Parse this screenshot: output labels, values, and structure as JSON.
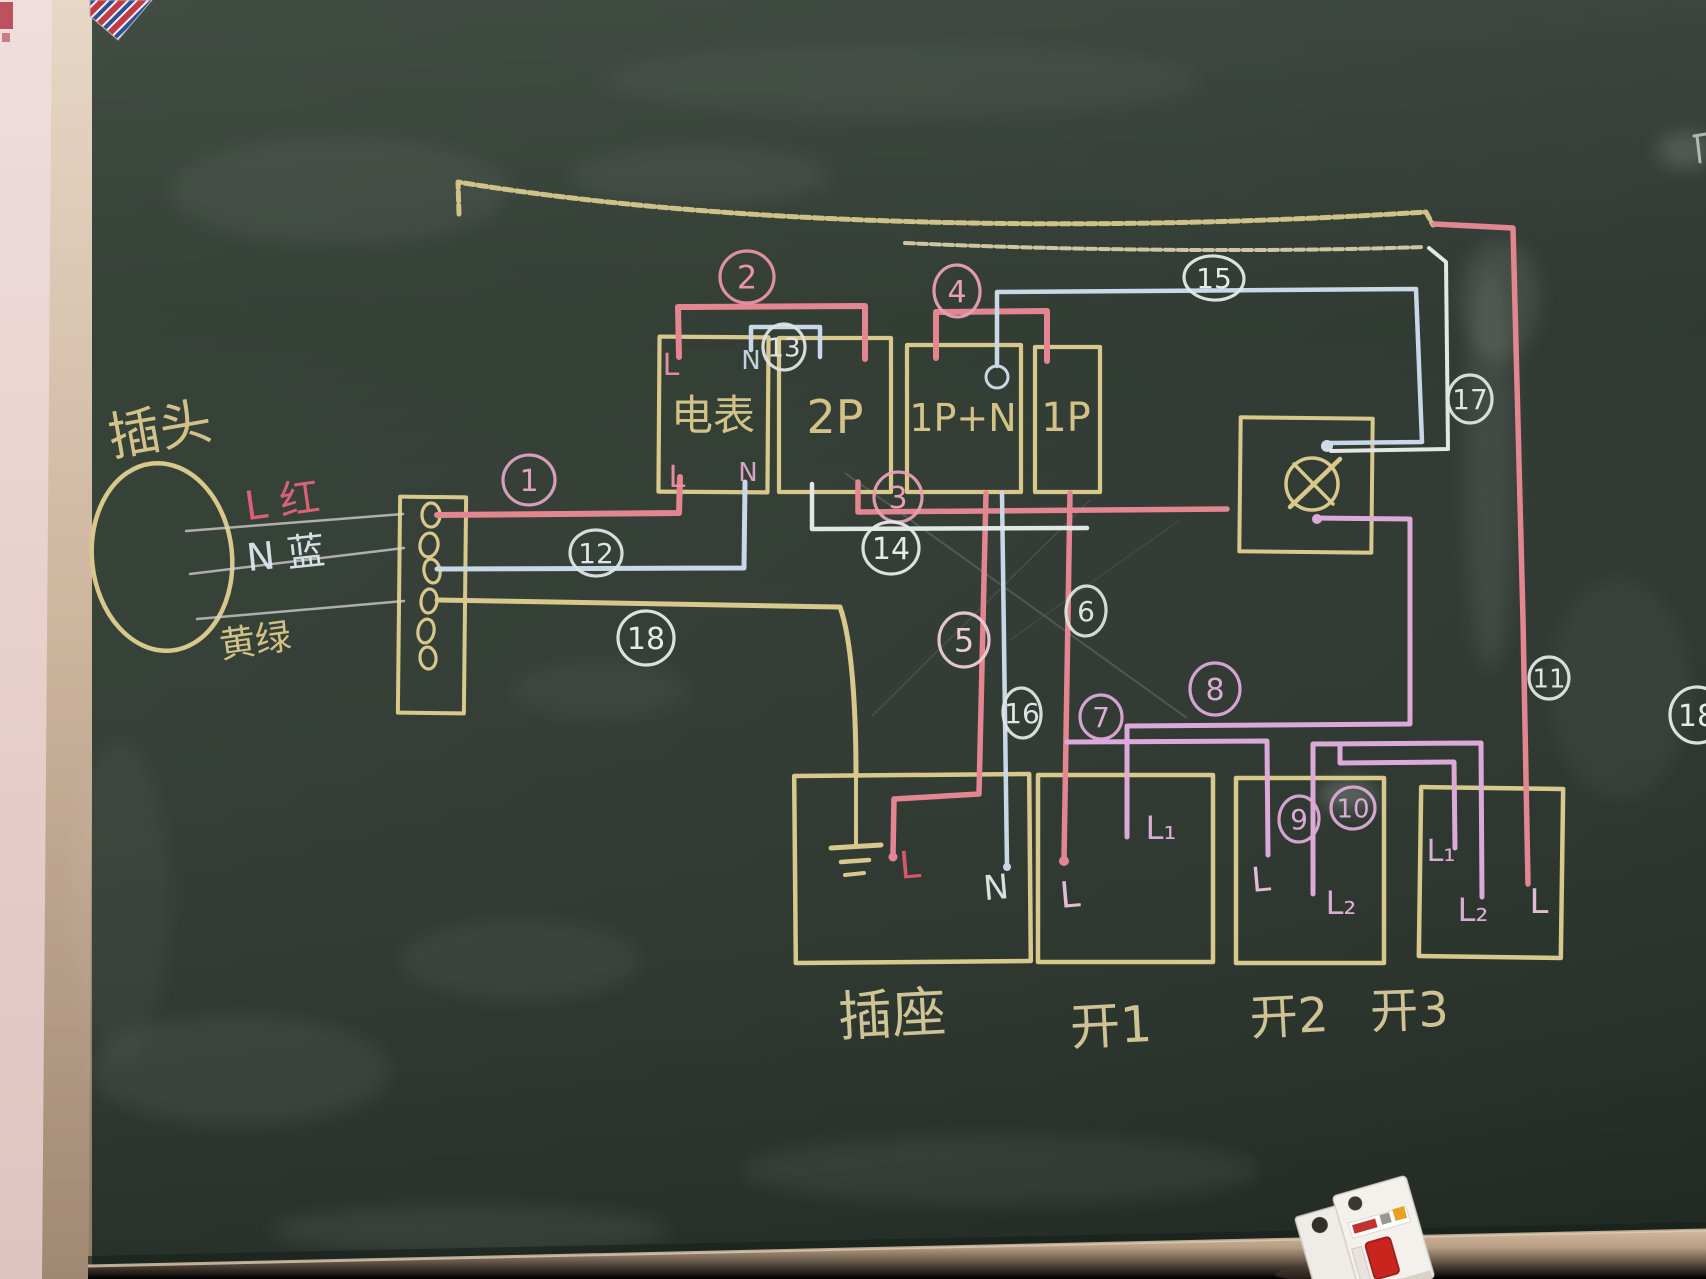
{
  "diagram": {
    "labels": [
      {
        "id": "plug-title",
        "text": "插头",
        "x": 163,
        "y": 447,
        "size": 52,
        "color": "#dcca8e",
        "rot": -10
      },
      {
        "id": "wire-live-label",
        "text": "L 红",
        "x": 284,
        "y": 515,
        "size": 40,
        "color": "#e3647c",
        "rot": -8
      },
      {
        "id": "wire-neutral-label",
        "text": "N 蓝",
        "x": 287,
        "y": 567,
        "size": 38,
        "color": "#dde7ee",
        "rot": -6
      },
      {
        "id": "wire-ground-label",
        "text": "黄绿",
        "x": 257,
        "y": 653,
        "size": 36,
        "color": "#d9c98c",
        "rot": -8
      },
      {
        "id": "meter-name",
        "text": "电表",
        "x": 713,
        "y": 430,
        "size": 42,
        "color": "#dcca8e",
        "rot": 0
      },
      {
        "id": "breaker-2p-name",
        "text": "2P",
        "x": 835,
        "y": 433,
        "size": 46,
        "color": "#dcca8e",
        "rot": 0
      },
      {
        "id": "breaker-1pn-name",
        "text": "1P+N",
        "x": 963,
        "y": 431,
        "size": 38,
        "color": "#dcca8e",
        "rot": 0
      },
      {
        "id": "breaker-1p-name",
        "text": "1P",
        "x": 1066,
        "y": 431,
        "size": 40,
        "color": "#dcca8e",
        "rot": 0
      },
      {
        "id": "socket-name",
        "text": "插座",
        "x": 893,
        "y": 1033,
        "size": 54,
        "color": "#d8cc9c",
        "rot": -3
      },
      {
        "id": "switch1-name",
        "text": "开1",
        "x": 1112,
        "y": 1043,
        "size": 50,
        "color": "#d8cc9c",
        "rot": -3
      },
      {
        "id": "switch2-name",
        "text": "开2",
        "x": 1290,
        "y": 1033,
        "size": 48,
        "color": "#d8cc9c",
        "rot": -3
      },
      {
        "id": "switch3-name",
        "text": "开3",
        "x": 1410,
        "y": 1027,
        "size": 48,
        "color": "#d8cc9c",
        "rot": -2
      },
      {
        "id": "meter-l-top",
        "text": "L",
        "x": 671,
        "y": 375,
        "size": 30,
        "color": "#ea93a6",
        "rot": 0
      },
      {
        "id": "meter-n-top",
        "text": "N",
        "x": 751,
        "y": 369,
        "size": 26,
        "color": "#ccdae8",
        "rot": 0
      },
      {
        "id": "meter-l-bottom",
        "text": "L",
        "x": 677,
        "y": 487,
        "size": 30,
        "color": "#ea93a6",
        "rot": 0
      },
      {
        "id": "meter-n-bottom",
        "text": "N",
        "x": 748,
        "y": 481,
        "size": 26,
        "color": "#dcaace",
        "rot": 0
      },
      {
        "id": "socket-l",
        "text": "L",
        "x": 911,
        "y": 878,
        "size": 38,
        "color": "#e0586f",
        "rot": -5
      },
      {
        "id": "socket-n",
        "text": "N",
        "x": 997,
        "y": 899,
        "size": 34,
        "color": "#e4e9ea",
        "rot": -5
      },
      {
        "id": "switch1-l",
        "text": "L",
        "x": 1071,
        "y": 907,
        "size": 36,
        "color": "#eec2de",
        "rot": -5
      },
      {
        "id": "switch1-l1",
        "text": "L₁",
        "x": 1161,
        "y": 839,
        "size": 32,
        "color": "#e2b6dc",
        "rot": 0
      },
      {
        "id": "switch2-l",
        "text": "L",
        "x": 1262,
        "y": 891,
        "size": 34,
        "color": "#eec2de",
        "rot": -5
      },
      {
        "id": "switch2-l2",
        "text": "L₂",
        "x": 1341,
        "y": 914,
        "size": 32,
        "color": "#e2b6dc",
        "rot": 0
      },
      {
        "id": "switch3-l1",
        "text": "L₁",
        "x": 1441,
        "y": 861,
        "size": 30,
        "color": "#e2b6dc",
        "rot": 0
      },
      {
        "id": "switch3-l2",
        "text": "L₂",
        "x": 1473,
        "y": 921,
        "size": 32,
        "color": "#e2b6dc",
        "rot": 0
      },
      {
        "id": "switch3-l",
        "text": "L",
        "x": 1539,
        "y": 913,
        "size": 34,
        "color": "#eec2de",
        "rot": 0
      }
    ],
    "badges": [
      {
        "n": "1",
        "x": 529,
        "y": 480,
        "rx": 26,
        "ry": 25,
        "color": "#e0a2c2",
        "fs": 30
      },
      {
        "n": "2",
        "x": 747,
        "y": 277,
        "rx": 27,
        "ry": 26,
        "color": "#ea94a4",
        "fs": 32
      },
      {
        "n": "3",
        "x": 898,
        "y": 497,
        "rx": 24,
        "ry": 25,
        "color": "#e8a0b4",
        "fs": 30
      },
      {
        "n": "4",
        "x": 957,
        "y": 291,
        "rx": 23,
        "ry": 26,
        "color": "#e8a0b4",
        "fs": 30
      },
      {
        "n": "5",
        "x": 964,
        "y": 640,
        "rx": 25,
        "ry": 27,
        "color": "#eccad8",
        "fs": 32
      },
      {
        "n": "6",
        "x": 1086,
        "y": 611,
        "rx": 20,
        "ry": 25,
        "color": "#dde2e0",
        "fs": 28
      },
      {
        "n": "7",
        "x": 1101,
        "y": 717,
        "rx": 21,
        "ry": 22,
        "color": "#dcaad8",
        "fs": 28
      },
      {
        "n": "8",
        "x": 1215,
        "y": 689,
        "rx": 25,
        "ry": 26,
        "color": "#dcaad8",
        "fs": 30
      },
      {
        "n": "9",
        "x": 1299,
        "y": 819,
        "rx": 20,
        "ry": 23,
        "color": "#dcaad8",
        "fs": 28
      },
      {
        "n": "10",
        "x": 1353,
        "y": 808,
        "rx": 22,
        "ry": 21,
        "color": "#dcaad8",
        "fs": 26
      },
      {
        "n": "11",
        "x": 1549,
        "y": 678,
        "rx": 20,
        "ry": 21,
        "color": "#e2e6e4",
        "fs": 26
      },
      {
        "n": "12",
        "x": 596,
        "y": 553,
        "rx": 26,
        "ry": 23,
        "color": "#dfe4e6",
        "fs": 28
      },
      {
        "n": "13",
        "x": 784,
        "y": 347,
        "rx": 21,
        "ry": 23,
        "color": "#dfe4e6",
        "fs": 26
      },
      {
        "n": "14",
        "x": 891,
        "y": 548,
        "rx": 28,
        "ry": 26,
        "color": "#e6eae8",
        "fs": 30
      },
      {
        "n": "15",
        "x": 1214,
        "y": 278,
        "rx": 30,
        "ry": 22,
        "color": "#e6eae8",
        "fs": 28
      },
      {
        "n": "16",
        "x": 1022,
        "y": 713,
        "rx": 19,
        "ry": 25,
        "color": "#dfe4e6",
        "fs": 28
      },
      {
        "n": "17",
        "x": 1470,
        "y": 399,
        "rx": 22,
        "ry": 24,
        "color": "#dfe4e6",
        "fs": 28
      },
      {
        "n": "18",
        "x": 646,
        "y": 638,
        "rx": 28,
        "ry": 27,
        "color": "#e6eae8",
        "fs": 30
      },
      {
        "n": "18",
        "x": 1697,
        "y": 715,
        "rx": 27,
        "ry": 28,
        "color": "#e6eae8",
        "fs": 30
      }
    ],
    "colors": {
      "board_green": "#2c362e",
      "chalk_yellow": "#d8c88c",
      "chalk_red_pink": "#e4８692",
      "chalk_pink": "#e48692",
      "chalk_violet": "#dcaad8",
      "chalk_blue": "#c8d8e6",
      "chalk_white": "#e2e6e4",
      "wall_pink": "#ecd9d6",
      "frame_tan": "#d5bca4",
      "tray_tan": "#b79e86",
      "breaker_toggle_red": "#c8251f"
    }
  }
}
